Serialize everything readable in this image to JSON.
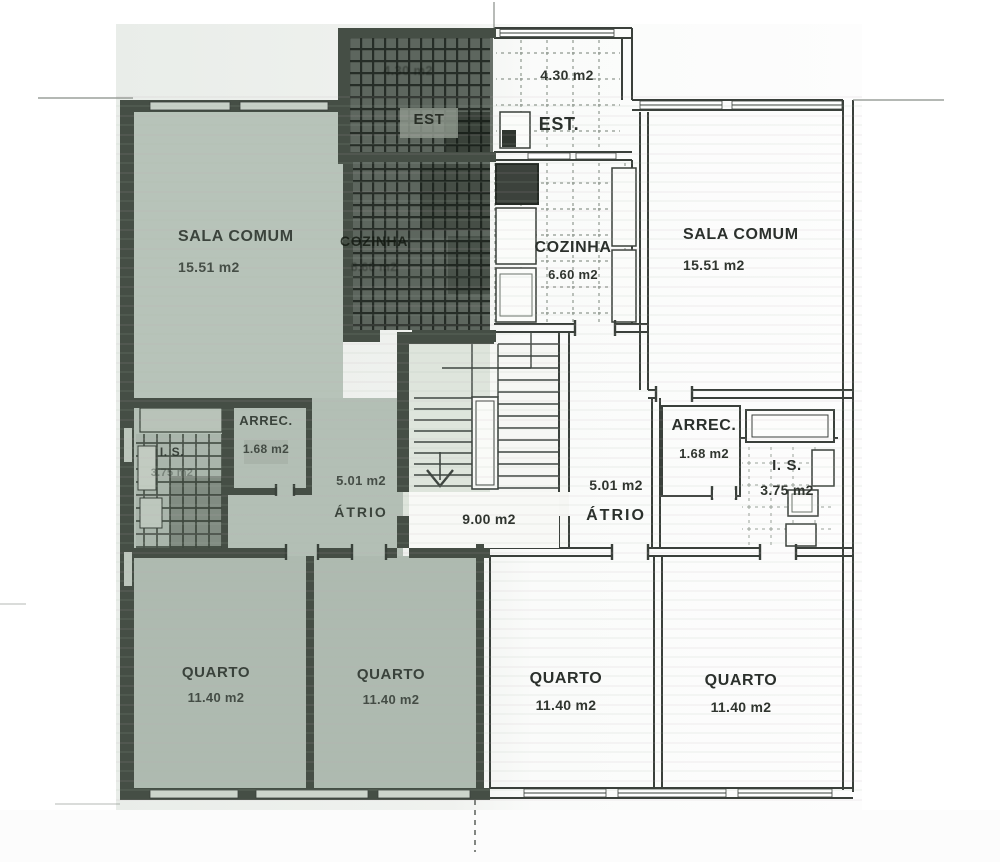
{
  "plan": {
    "type": "architectural-floor-plan",
    "rooms": {
      "est_left": {
        "name": "EST",
        "area": "4.30 m2"
      },
      "est_right": {
        "name": "EST.",
        "area": "4.30 m2"
      },
      "sala_left": {
        "name": "SALA COMUM",
        "area": "15.51 m2"
      },
      "sala_right": {
        "name": "SALA COMUM",
        "area": "15.51 m2"
      },
      "cozinha_left": {
        "name": "COZINHA",
        "area": "6.60 m2"
      },
      "cozinha_right": {
        "name": "COZINHA",
        "area": "6.60 m2"
      },
      "arrec_left": {
        "name": "ARREC.",
        "area": "1.68 m2"
      },
      "arrec_right": {
        "name": "ARREC.",
        "area": "1.68 m2"
      },
      "is_left": {
        "name": "I. S.",
        "area": "3.75 m2"
      },
      "is_right": {
        "name": "I. S.",
        "area": "3.75 m2"
      },
      "atrio_left": {
        "name": "ÁTRIO",
        "area": "5.01 m2"
      },
      "atrio_right": {
        "name": "ÁTRIO",
        "area": "5.01 m2"
      },
      "stair_landing": {
        "area": "9.00 m2"
      },
      "quarto_1": {
        "name": "QUARTO",
        "area": "11.40 m2"
      },
      "quarto_2": {
        "name": "QUARTO",
        "area": "11.40 m2"
      },
      "quarto_3": {
        "name": "QUARTO",
        "area": "11.40 m2"
      },
      "quarto_4": {
        "name": "QUARTO",
        "area": "11.40 m2"
      }
    },
    "colors": {
      "highlight_tint": "#b6c2b8",
      "dark_hatch": "#5d665e",
      "wall_dark": "#454e45",
      "line": "#3a403b",
      "paper": "#fafbfa"
    }
  }
}
